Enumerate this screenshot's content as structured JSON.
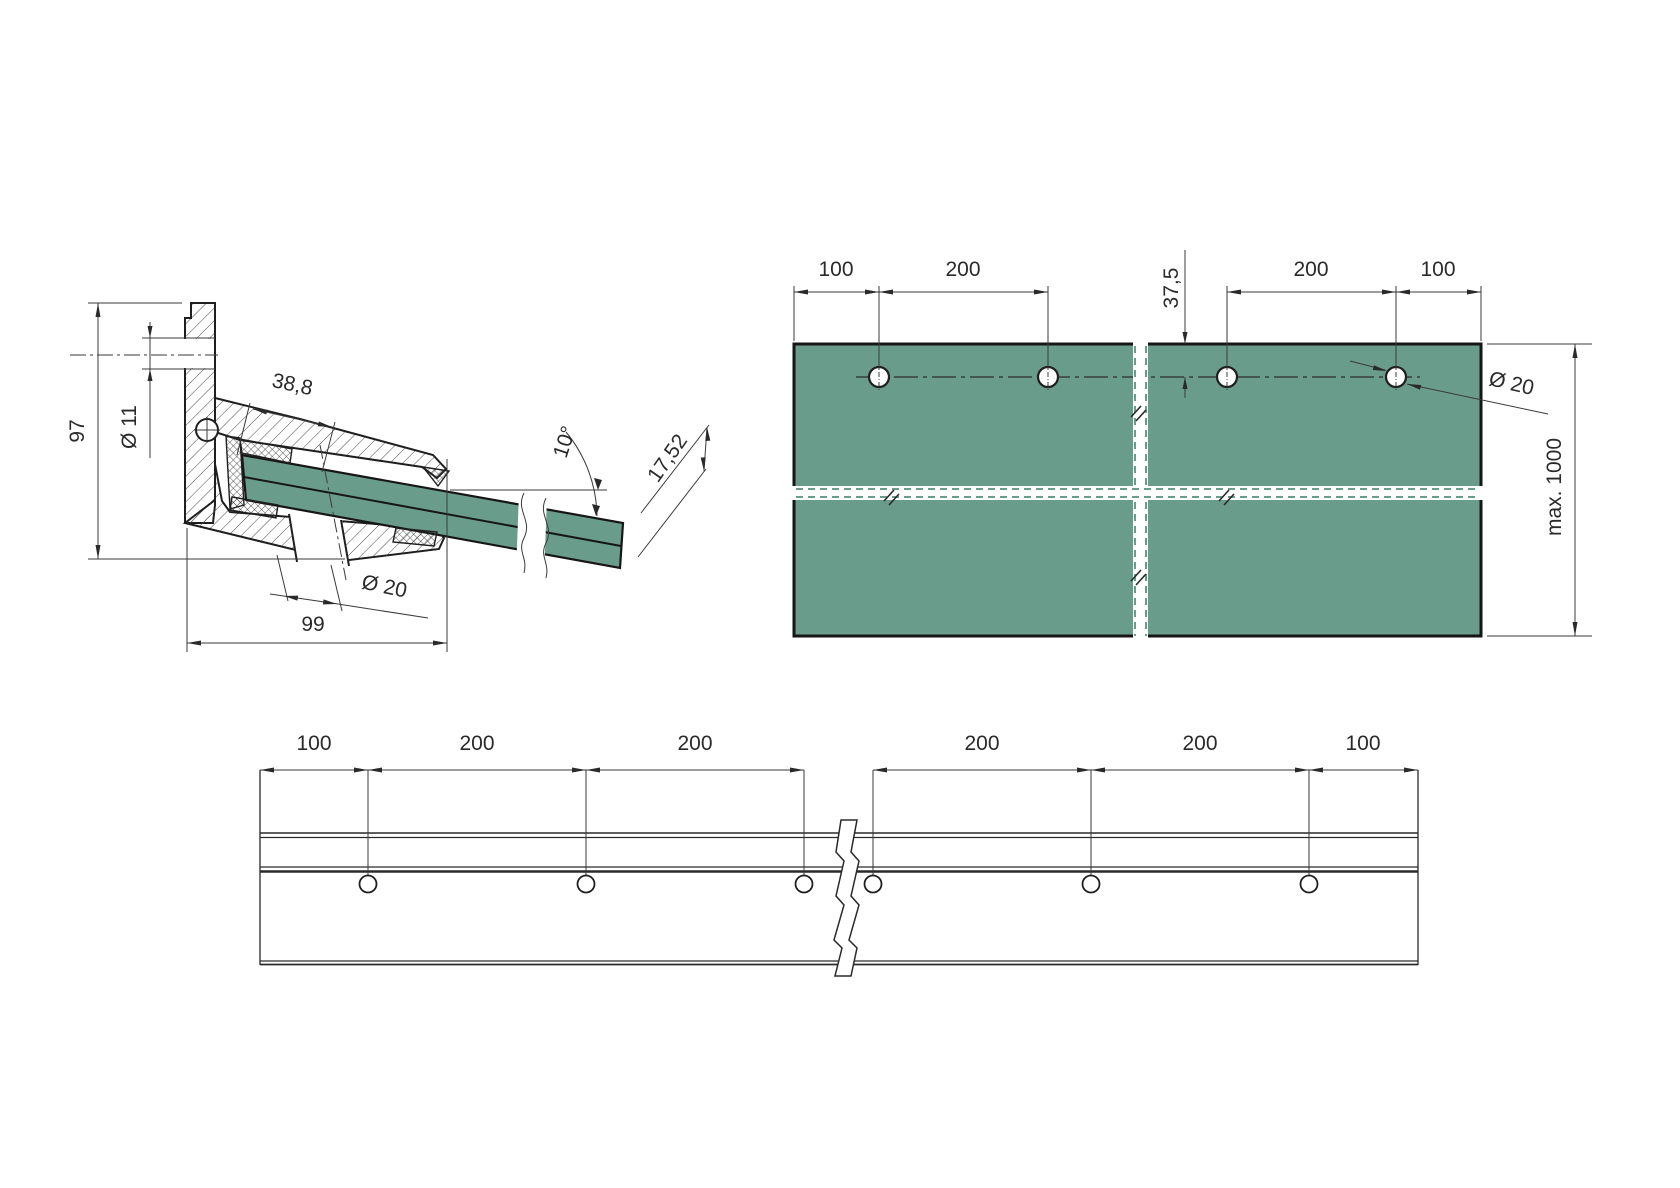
{
  "drawing": {
    "type": "technical-drawing",
    "subject": "glass canopy wall bracket with laminated glass panel",
    "views": [
      "section",
      "plan",
      "front-elevation"
    ]
  },
  "colors": {
    "glass": "#6A9C8C",
    "line": "#1f1f1f",
    "dimension": "#3a3a3a"
  },
  "section_view": {
    "height": "97",
    "slot_diameter": "Ø 11",
    "hole_offset": "38,8",
    "glass_angle": "10°",
    "glass_thickness": "17,52",
    "hole_diameter": "Ø 20",
    "depth": "99"
  },
  "plan_view": {
    "edge_offset_left": "100",
    "hole_spacing_left": "200",
    "hole_edge_distance": "37,5",
    "hole_spacing_right": "200",
    "edge_offset_right": "100",
    "hole_diameter": "Ø 20",
    "max_length": "max. 1000",
    "hole_count": 4
  },
  "front_view": {
    "dims": [
      "100",
      "200",
      "200",
      "200",
      "200",
      "100"
    ],
    "hole_count": 6
  }
}
